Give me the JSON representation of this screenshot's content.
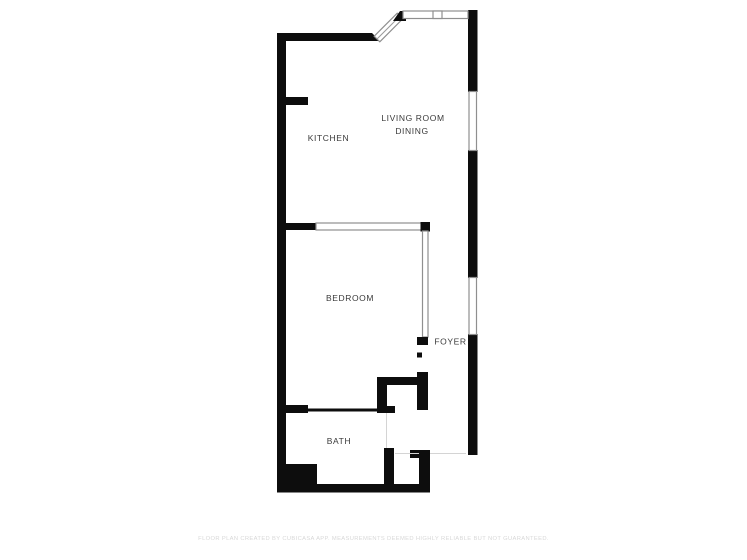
{
  "floor_plan": {
    "rooms": {
      "kitchen": {
        "label": "KITCHEN"
      },
      "living_dining": {
        "label_line1": "LIVING ROOM",
        "label_line2": "DINING"
      },
      "bedroom": {
        "label": "BEDROOM"
      },
      "foyer": {
        "label": "FOYER"
      },
      "bath": {
        "label": "BATH"
      }
    },
    "colors": {
      "wall": "#0d0d0d",
      "window_outline": "#8f8f8f",
      "room_label_text": "#3a3a3a",
      "opening_line": "#d4d4d4",
      "disclaimer_text": "#d8d8d8",
      "background": "#ffffff"
    }
  },
  "footer": {
    "disclaimer": "FLOOR PLAN CREATED BY CUBICASA APP. MEASUREMENTS DEEMED HIGHLY RELIABLE BUT NOT GUARANTEED."
  }
}
